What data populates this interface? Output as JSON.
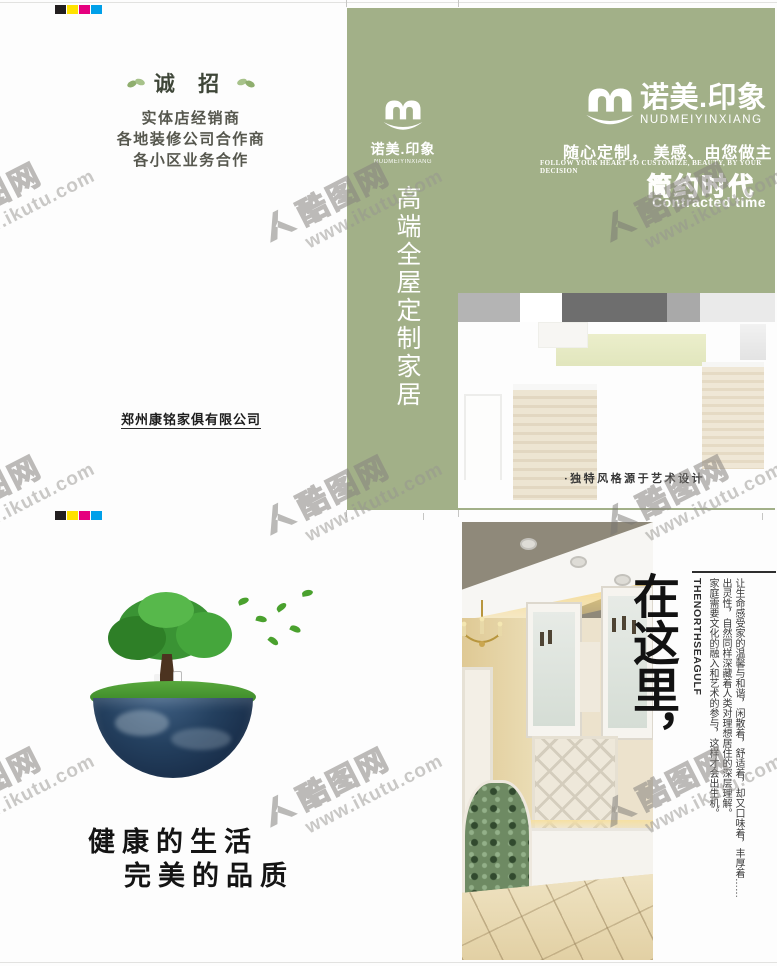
{
  "colors": {
    "brochure_green": "#a2b088",
    "reg_black": "#231f20",
    "reg_yellow": "#ffe200",
    "reg_magenta": "#e5007e",
    "reg_cyan": "#00a0e9"
  },
  "watermark": {
    "brand": "酷图网",
    "url": "www.ikutu.com"
  },
  "outside": {
    "back_panel": {
      "recruit_heading": "诚 招",
      "recruit_lines": [
        "实体店经销商",
        "各地装修公司合作商",
        "各小区业务合作"
      ],
      "company": "郑州康铭家俱有限公司"
    },
    "spine_panel": {
      "brand_cn": "诺美.印象",
      "brand_en": "NUDMEIYINXIANG",
      "vertical_title": "高端全屋定制家居"
    },
    "cover_panel": {
      "brand_cn": "诺美.印象",
      "brand_en": "NUDMEIYINXIANG",
      "tagline_cn": "随心定制， 美感、由您做主",
      "tagline_en": "FOLLOW YOUR HEART TO CUSTOMIZE, BEAUTY, BY YOUR DECISION",
      "era_cn": "简约时代",
      "era_en": "Contracted time",
      "photo_caption": "·独特风格源于艺术设计"
    }
  },
  "inside": {
    "left_panel": {
      "slogan_line1": "健康的生活",
      "slogan_line2": "完美的品质"
    },
    "right_panel": {
      "headline": "在这里，",
      "vertical_en": "THENORTHSEAGULF",
      "paragraph_columns": [
        "让生命感受家的温馨与和谐，闲散着，舒适着，却又口味着，丰厚着……",
        "出灵性，自然同样深藏着人类对理想居住的深层理解。",
        "家庭需要文化的融入和艺术的参与，这样才会出生机。"
      ]
    }
  }
}
